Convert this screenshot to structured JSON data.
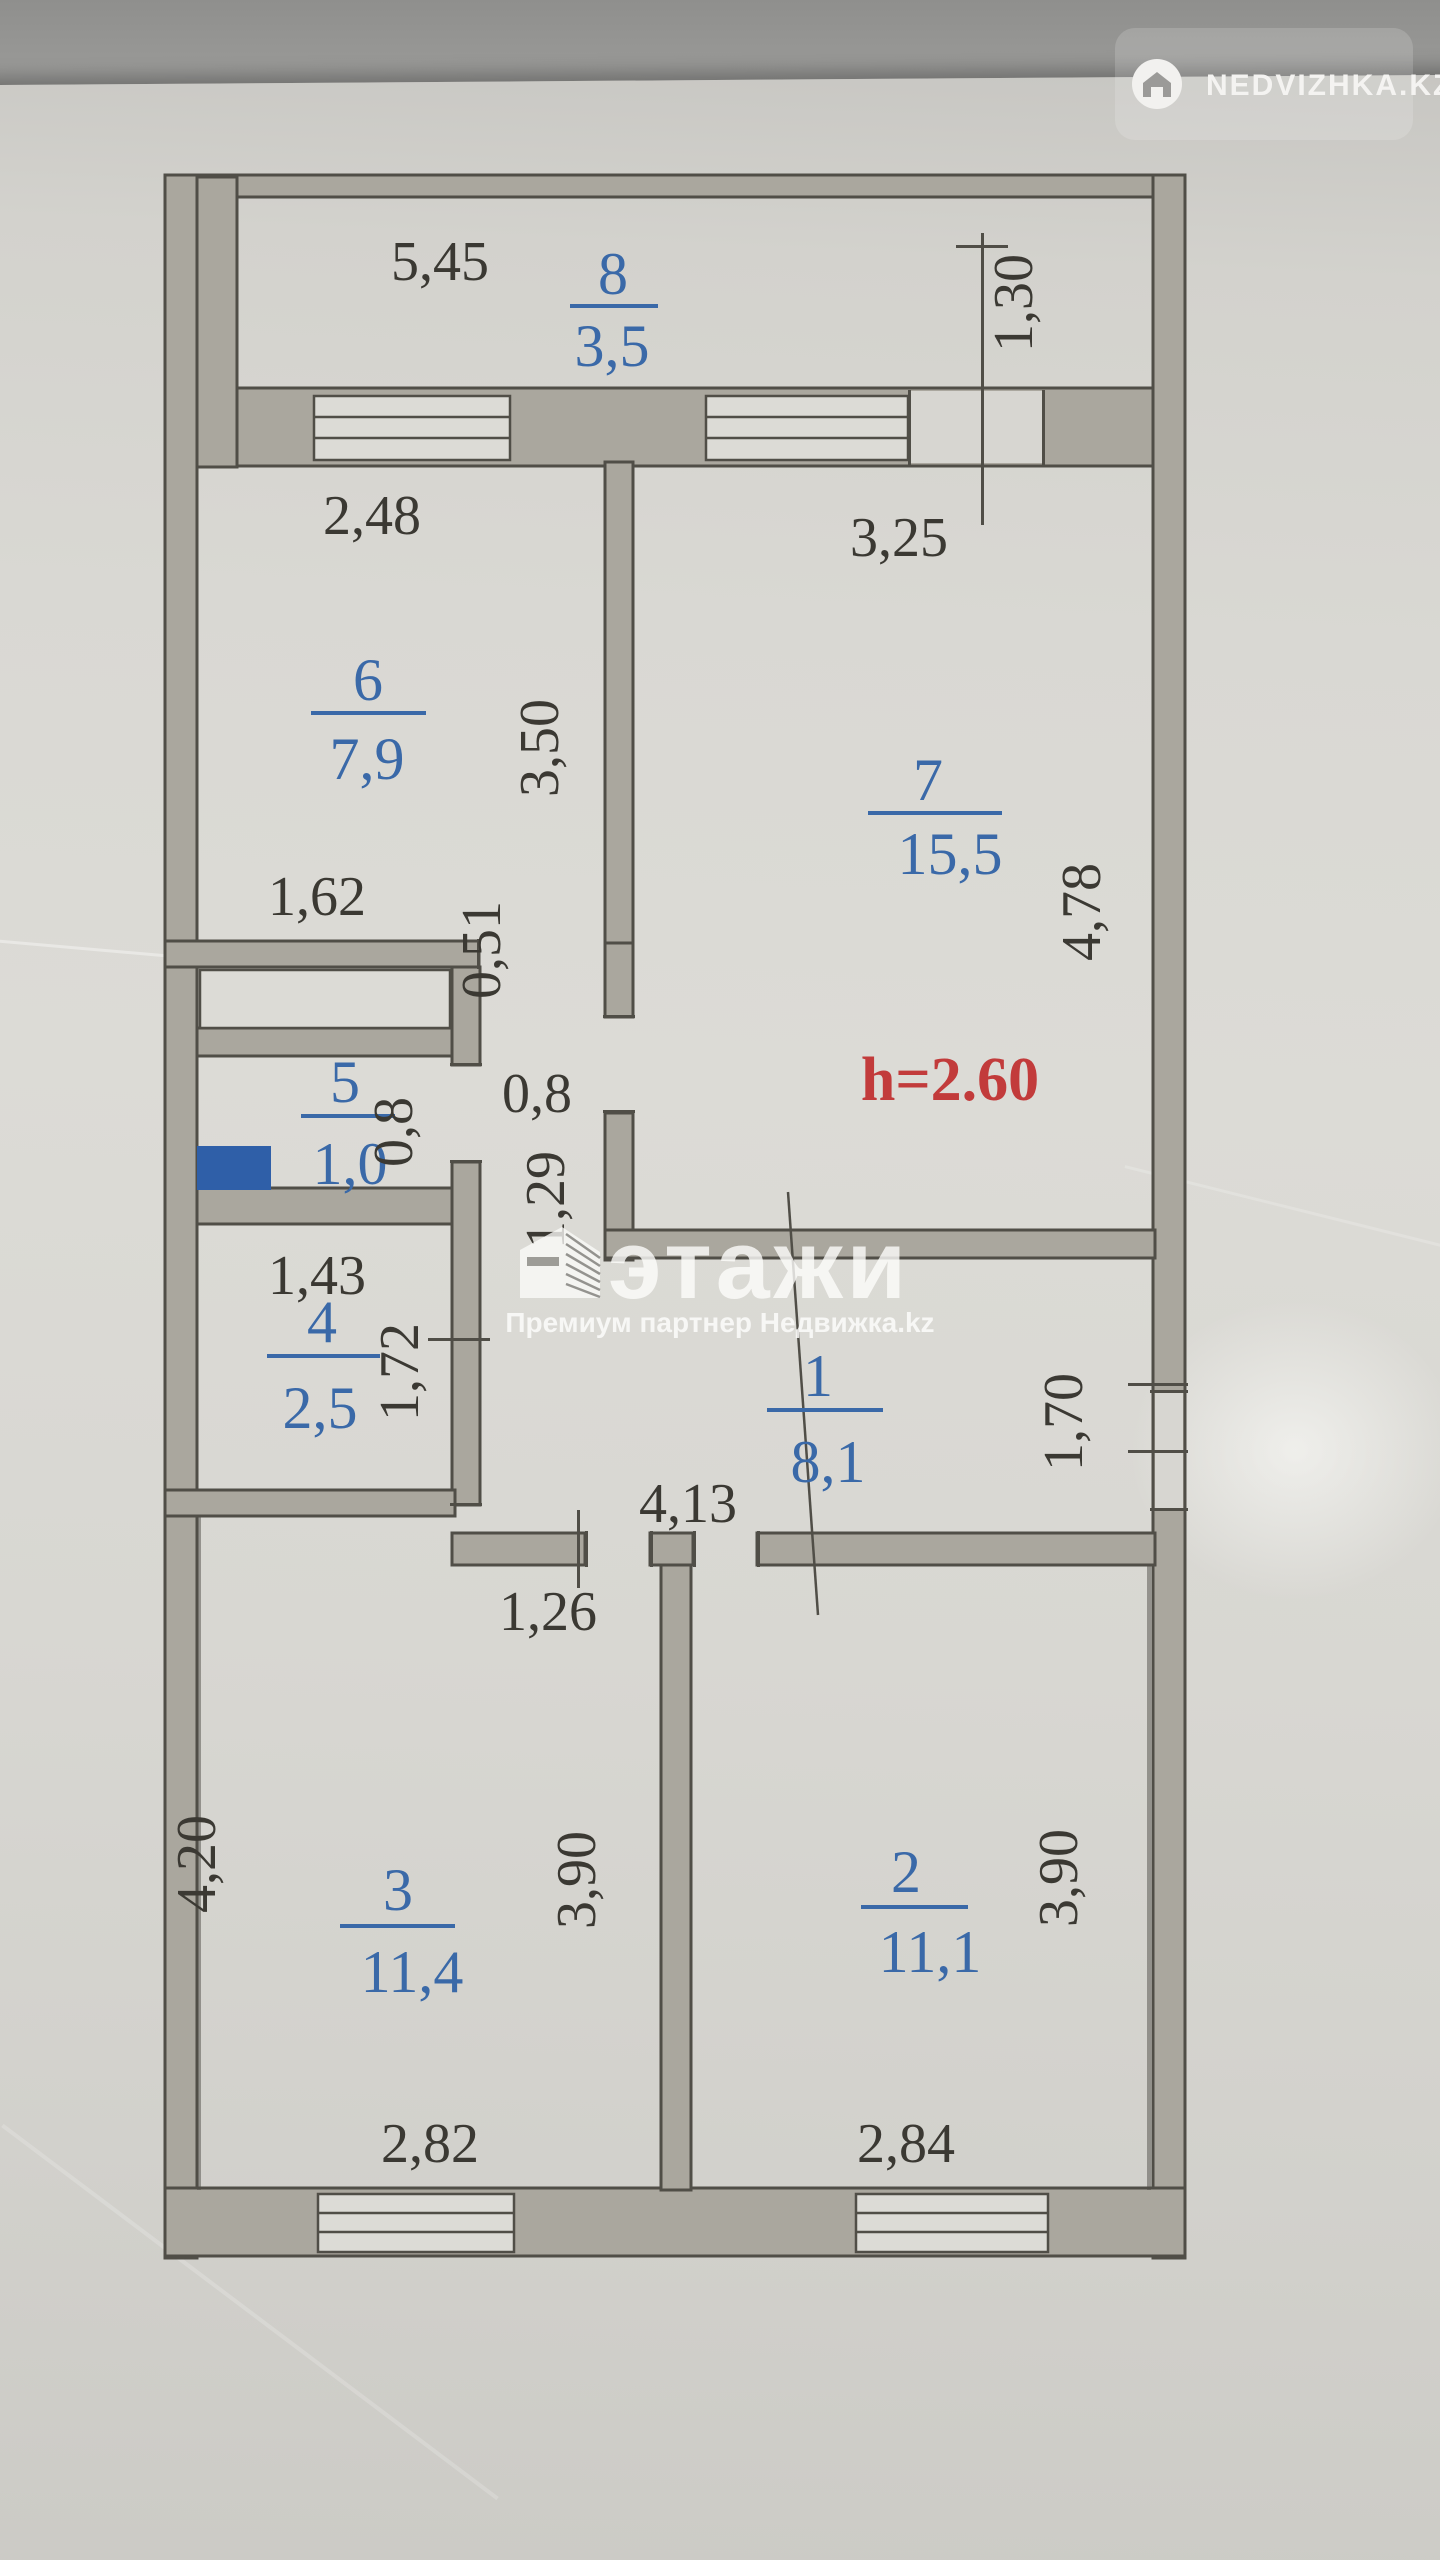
{
  "badge": {
    "label": "NEDVIZHKA.KZ"
  },
  "watermark": {
    "brand": "этажи",
    "subtitle": "Премиум партнер Недвижка.kz"
  },
  "plan": {
    "ceiling_height": "h=2.60",
    "rooms": [
      {
        "number": "8",
        "area": "3,5"
      },
      {
        "number": "6",
        "area": "7,9"
      },
      {
        "number": "7",
        "area": "15,5"
      },
      {
        "number": "5",
        "area": "1,0"
      },
      {
        "number": "4",
        "area": "2,5"
      },
      {
        "number": "1",
        "area": "8,1"
      },
      {
        "number": "3",
        "area": "11,4"
      },
      {
        "number": "2",
        "area": "11,1"
      }
    ],
    "dims": {
      "d545": "5,45",
      "d130": "1,30",
      "d248": "2,48",
      "d325": "3,25",
      "d350": "3,50",
      "d478": "4,78",
      "d162": "1,62",
      "d051": "0,51",
      "d08a": "0,8",
      "d08b": "0,8",
      "d129": "1,29",
      "d143": "1,43",
      "d172": "1,72",
      "d413": "4,13",
      "d170": "1,70",
      "d126": "1,26",
      "d420": "4,20",
      "d390a": "3,90",
      "d390b": "3,90",
      "d282": "2,82",
      "d284": "2,84"
    },
    "colors": {
      "room_label": "#3a69a8",
      "dimension": "#3b3933",
      "height_note": "#c23b3b",
      "marker": "#2f5fa8"
    }
  }
}
